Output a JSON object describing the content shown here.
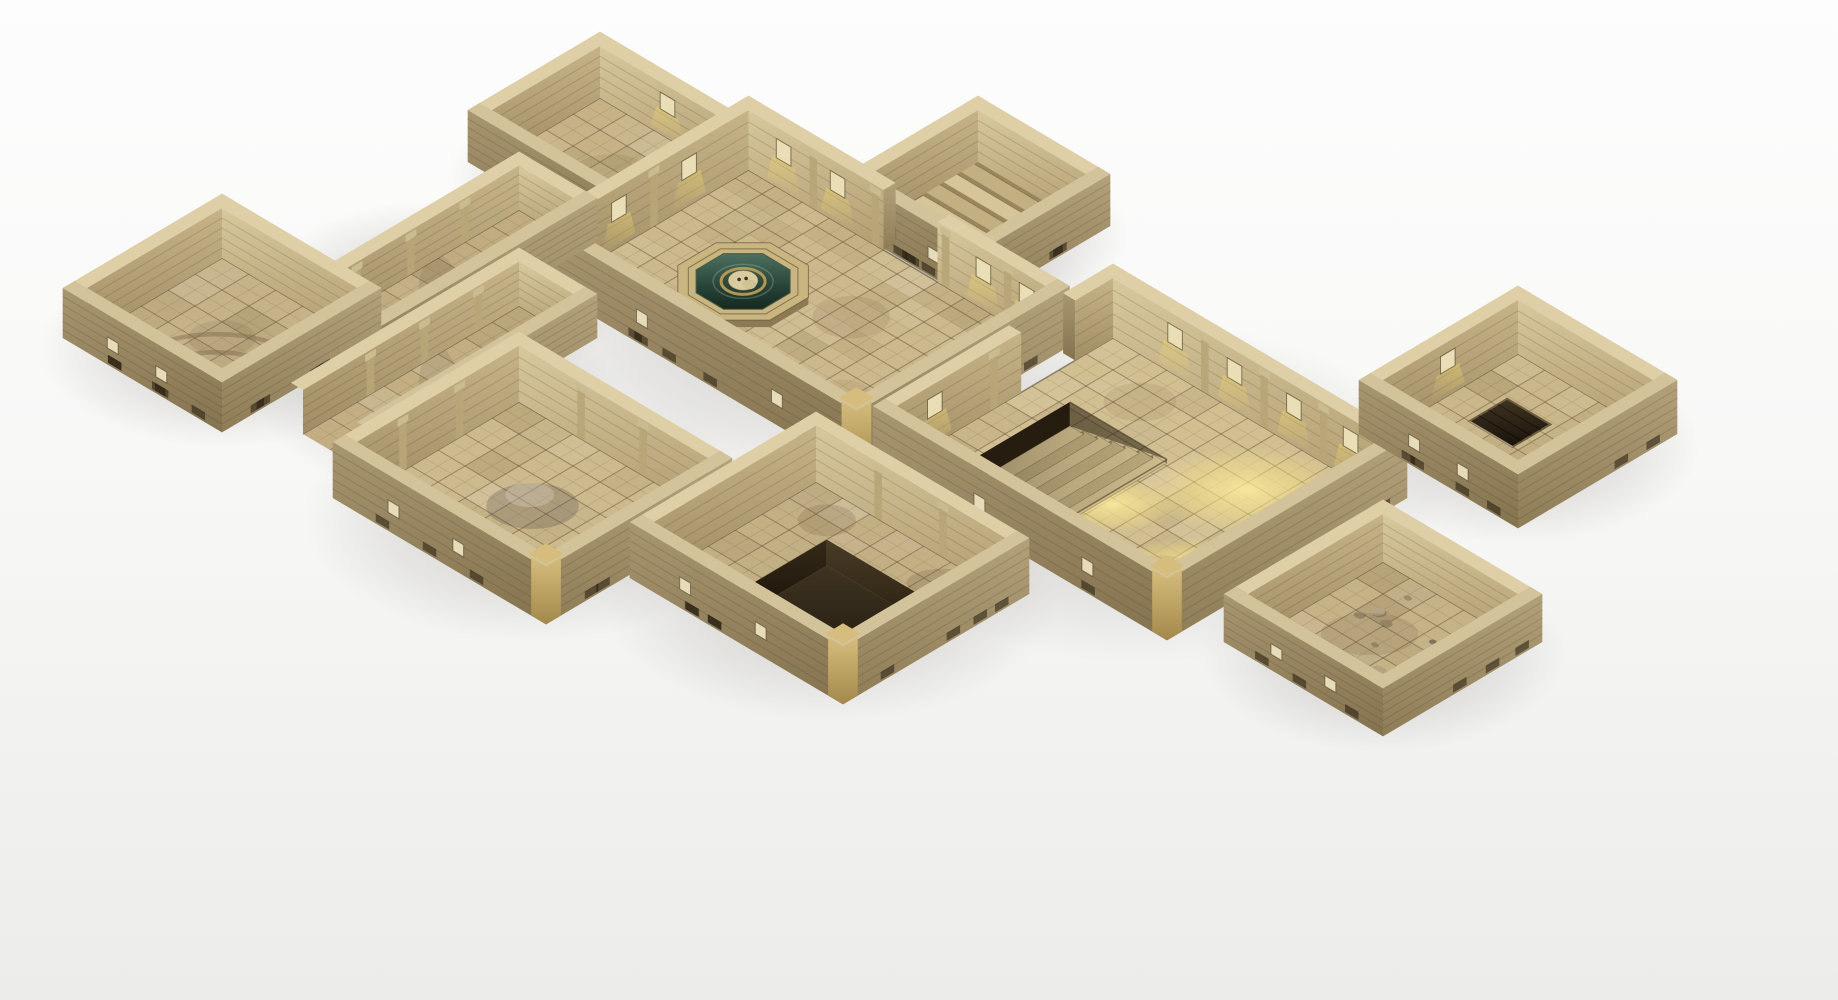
{
  "scene": {
    "canvas": {
      "w": 1838,
      "h": 1000
    },
    "projection": {
      "ox": 627,
      "oy": 50,
      "ux": 27,
      "uy": 16,
      "t": 0.45
    },
    "palette": {
      "grid": "rgba(84,66,40,0.45)",
      "subgrid": "rgba(84,66,40,0.16)",
      "brick": "rgba(62,48,28,0.18)",
      "window": "#eadeb6",
      "window_stroke": "rgba(70,56,34,0.6)",
      "top": "#decfa6",
      "top_side": "#d2c39a",
      "edge": "rgba(60,46,26,0.5)",
      "base_mark": "rgba(28,20,10,0.5)",
      "vent": "#e7dcba",
      "lip": "rgba(72,58,34,0.6)",
      "highlight": "rgba(238,228,198,0.45)",
      "pilaster": "#b7a577",
      "pilaster_cap": "#cbbb90",
      "riser": "#9a855c",
      "riser_sunk": "#8d7850",
      "tread_a": "#d5c598",
      "tread_b": "#c2b083",
      "fountain_rim": "#c8b57f",
      "fountain_skirt": "#8d7a55",
      "skull": "#d9cca0",
      "skull_snout": "#cfc293",
      "gold_coil": "#bfa058",
      "water_stroke": "#4e5a3f",
      "rubble": [
        "#b3a584",
        "#9a8b6b",
        "#80735a"
      ]
    },
    "rooms": [
      {
        "id": "antechamber",
        "rect": [
          1,
          2,
          6,
          6
        ],
        "h": 52,
        "floor": "#c6b286",
        "sides": [
          "n",
          "w",
          "s",
          "e"
        ],
        "windows": {
          "n": [
            3.5
          ]
        },
        "pilasters": {},
        "gaps": {},
        "vents": {
          "s": [
            2.8,
            4.6
          ]
        },
        "corner_trim": false,
        "features": [],
        "stains": [
          [
            3.5,
            4.1,
            1.5,
            1.0,
            "#7b6947",
            0.15
          ],
          [
            4.6,
            5.0,
            0.9,
            0.7,
            "#9a7850",
            0.12
          ]
        ]
      },
      {
        "id": "stair-room",
        "rect": [
          10,
          -3,
          14,
          1
        ],
        "h": 52,
        "floor": "#c7b487",
        "sides": [
          "n",
          "w",
          "s",
          "e"
        ],
        "windows": {},
        "pilasters": {},
        "gaps": {},
        "vents": {
          "s": [
            11.2,
            12.8
          ]
        },
        "corner_trim": false,
        "features": [
          {
            "type": "stairs",
            "rect": [
              10.3,
              -2.7,
              13.7,
              0.85
            ],
            "axis": "y",
            "steps": 7,
            "rise": 26
          }
        ],
        "stains": []
      },
      {
        "id": "fountain-hall",
        "rect": [
          6,
          1.5,
          17,
          8.5
        ],
        "h": 60,
        "floor": "#cbb88c",
        "sides": [
          "n",
          "w",
          "s",
          "e"
        ],
        "windows": {
          "n": [
            7.3,
            9.3,
            14.7,
            16.3
          ],
          "w": [
            3.7,
            6.3
          ]
        },
        "pilasters": {
          "n": [
            8.4,
            10.7,
            13.3,
            15.6
          ],
          "w": [
            5.0
          ]
        },
        "gaps": {
          "n": [
            [
              11.0,
              13.0
            ]
          ]
        },
        "vents": {
          "s": [
            9.5,
            14.5
          ]
        },
        "corner_trim": true,
        "features": [
          {
            "type": "fountain",
            "cx": 9.6,
            "cy": 5.3,
            "r": 1.85
          }
        ],
        "stains": [
          [
            12.5,
            4.2,
            1.6,
            1.2,
            "#7d6a48",
            0.16
          ],
          [
            14.8,
            6.8,
            1.2,
            0.9,
            "#8a5f3a",
            0.12
          ],
          [
            8.2,
            7.4,
            1.4,
            1.0,
            "#6d5d40",
            0.14
          ],
          [
            11.5,
            7.6,
            2.0,
            1.2,
            "#e4d5a8",
            0.25
          ]
        ]
      },
      {
        "id": "west-corridor",
        "rect": [
          3,
          7,
          5,
          15
        ],
        "h": 44,
        "floor": "#c0ac80",
        "sides": [
          "n",
          "w",
          "e"
        ],
        "windows": {},
        "pilasters": {
          "w": [
            9.0,
            11.0,
            13.0
          ]
        },
        "gaps": {},
        "vents": {},
        "corner_trim": false,
        "features": [],
        "stains": [
          [
            4.0,
            11.0,
            0.8,
            2.0,
            "#6e5e40",
            0.16
          ]
        ]
      },
      {
        "id": "west-room",
        "rect": [
          -1,
          14,
          4,
          19
        ],
        "h": 50,
        "floor": "#c5b288",
        "sides": [
          "n",
          "w",
          "s",
          "e"
        ],
        "windows": {},
        "pilasters": {},
        "gaps": {},
        "vents": {
          "s": [
            0.4,
            2.2
          ]
        },
        "corner_trim": false,
        "features": [
          {
            "type": "arcs",
            "cx": 3.4,
            "cy": 18.6,
            "radii": [
              1.4,
              2.2,
              3.0
            ],
            "a0": 178,
            "a1": 262
          }
        ],
        "stains": [
          [
            1.5,
            16.5,
            1.4,
            1.0,
            "#7a6848",
            0.15
          ]
        ]
      },
      {
        "id": "mid-corridor",
        "rect": [
          6,
          10,
          8,
          18
        ],
        "h": 44,
        "floor": "#c2ae82",
        "sides": [
          "n",
          "w",
          "e"
        ],
        "windows": {},
        "pilasters": {
          "w": [
            11.5,
            13.5,
            15.5
          ]
        },
        "gaps": {},
        "vents": {},
        "corner_trim": false,
        "features": [],
        "stains": [
          [
            7.0,
            14.0,
            0.8,
            2.2,
            "#6e5e40",
            0.16
          ]
        ]
      },
      {
        "id": "great-hall",
        "rect": [
          18,
          0,
          28,
          8
        ],
        "h": 60,
        "floor": "#d1bf92",
        "sides": [
          "n",
          "w",
          "s",
          "e"
        ],
        "windows": {
          "n": [
            20.3,
            22.5,
            24.7,
            26.8
          ],
          "w": [
            6.6
          ]
        },
        "pilasters": {
          "n": [
            21.4,
            23.6,
            25.8
          ],
          "w": [
            4.4
          ]
        },
        "gaps": {
          "w": [
            [
              1.4,
              3.4
            ]
          ]
        },
        "vents": {
          "s": [
            21.5,
            25.5
          ]
        },
        "corner_trim": true,
        "features": [
          {
            "type": "sun",
            "cx": 25.2,
            "cy": 2.3,
            "rx": 2.4,
            "ry": 1.7
          },
          {
            "type": "sun",
            "cx": 23.2,
            "cy": 5.2,
            "rx": 1.5,
            "ry": 1.1
          },
          {
            "type": "sun",
            "cx": 26.6,
            "cy": 5.8,
            "rx": 1.7,
            "ry": 1.2
          },
          {
            "type": "stairs",
            "rect": [
              19.2,
              2.8,
              22.8,
              7.2
            ],
            "axis": "x",
            "steps": 7,
            "sunk": 24
          }
        ],
        "stains": [
          [
            20.5,
            1.5,
            1.5,
            1.1,
            "#7d6a48",
            0.14
          ],
          [
            26.3,
            6.6,
            1.8,
            1.2,
            "#8a6a40",
            0.12
          ]
        ]
      },
      {
        "id": "northeast-room",
        "rect": [
          26,
          -7,
          31,
          -2
        ],
        "h": 54,
        "floor": "#c9b68a",
        "sides": [
          "n",
          "w",
          "s",
          "e"
        ],
        "windows": {
          "w": [
            -4.4
          ]
        },
        "pilasters": {},
        "gaps": {},
        "vents": {
          "s": [
            27.6,
            29.4
          ]
        },
        "corner_trim": false,
        "features": [
          {
            "type": "hatch",
            "rect": [
              27.2,
              -5.4,
              28.8,
              -4.0
            ]
          }
        ],
        "stains": [
          [
            29.5,
            -2.8,
            1.5,
            1.0,
            "#6f5f42",
            0.16
          ]
        ]
      },
      {
        "id": "southwest-room",
        "rect": [
          9,
          13,
          16,
          19
        ],
        "h": 56,
        "floor": "#ccb98d",
        "sides": [
          "n",
          "w",
          "s",
          "e"
        ],
        "windows": {},
        "pilasters": {
          "n": [
            11.3,
            13.6
          ],
          "w": [
            15.2,
            17.3
          ]
        },
        "gaps": {},
        "vents": {
          "s": [
            10.8,
            13.2
          ]
        },
        "corner_trim": true,
        "features": [],
        "stains": [
          [
            12.5,
            16.0,
            1.9,
            1.3,
            "#55504a",
            0.28
          ],
          [
            12.1,
            15.7,
            1.0,
            0.7,
            "#d9d2c4",
            0.35
          ],
          [
            14.5,
            17.5,
            1.3,
            0.9,
            "#7a684a",
            0.15
          ]
        ]
      },
      {
        "id": "pit-room",
        "rect": [
          17,
          10,
          24,
          16
        ],
        "h": 56,
        "floor": "#c3af84",
        "sides": [
          "n",
          "w",
          "s",
          "e"
        ],
        "windows": {},
        "pilasters": {
          "n": [
            19.3,
            21.7
          ]
        },
        "gaps": {},
        "vents": {
          "s": [
            18.6,
            21.4
          ]
        },
        "corner_trim": true,
        "features": [
          {
            "type": "pit",
            "rect": [
              19.0,
              11.6,
              23.2,
              15.3
            ],
            "grate": [
              21.1,
              13.2,
              23.2,
              15.3
            ],
            "depth": 26
          }
        ],
        "stains": [
          [
            18.4,
            11.0,
            1.2,
            0.9,
            "#6d5c3e",
            0.2
          ],
          [
            22.5,
            10.8,
            1.5,
            0.8,
            "#5f5138",
            0.2
          ]
        ]
      },
      {
        "id": "east-room",
        "rect": [
          30,
          2,
          35,
          7
        ],
        "h": 48,
        "floor": "#c6b287",
        "sides": [
          "n",
          "w",
          "s",
          "e"
        ],
        "windows": {},
        "pilasters": {},
        "gaps": {},
        "vents": {
          "s": [
            31.5,
            33.5
          ]
        },
        "corner_trim": false,
        "features": [
          {
            "type": "rubble",
            "rect": [
              30.6,
              2.6,
              34.4,
              6.4
            ],
            "count": 12
          }
        ],
        "stains": [
          [
            32.0,
            4.5,
            2.0,
            1.2,
            "#70604a",
            0.18
          ]
        ]
      }
    ]
  }
}
